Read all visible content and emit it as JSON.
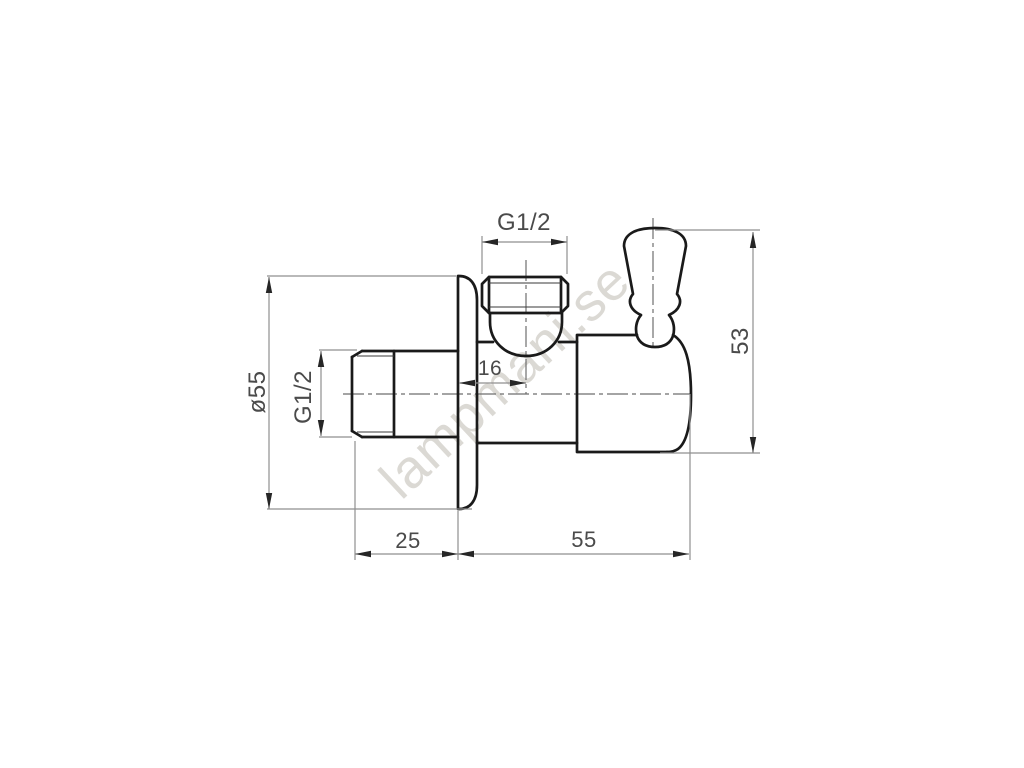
{
  "drawing": {
    "watermark": "lampmani.se",
    "background": "#ffffff",
    "colors": {
      "outline": "#1a1a1a",
      "detail_line": "#3a3a3a",
      "centerline": "#6e6e6e",
      "dimension_line": "#8f8f8f",
      "arrow": "#262626",
      "dimension_text": "#4a4a4a",
      "watermark_text": "#aaa498"
    },
    "dimensions": {
      "top_port_thread": "G1/2",
      "inlet_thread": "G1/2",
      "flange_diameter": "ø55",
      "wall_to_port_center": "16",
      "overall_height": "53",
      "inlet_projection": "25",
      "body_depth": "55"
    }
  }
}
